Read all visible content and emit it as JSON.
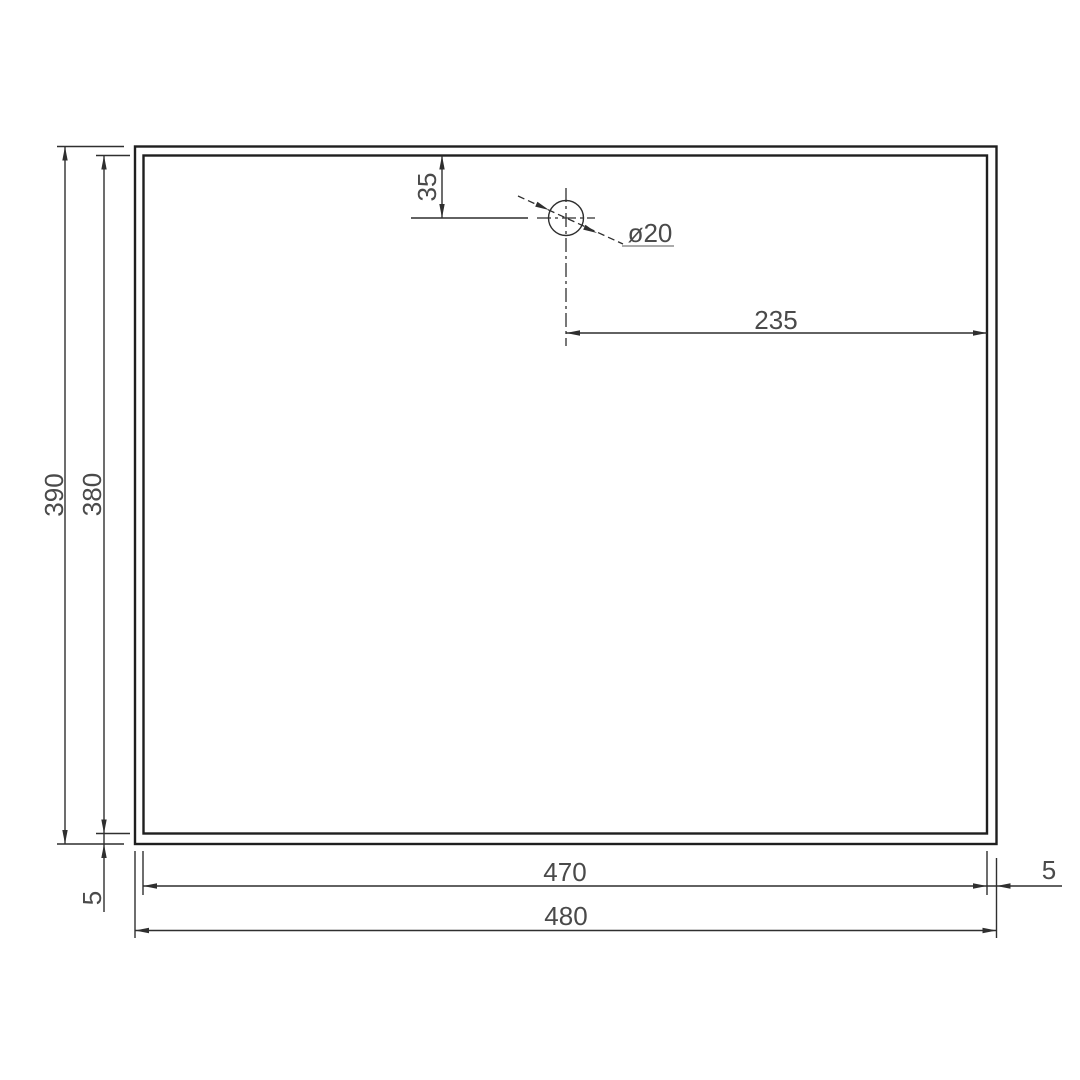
{
  "drawing": {
    "type": "engineering-dimension-drawing",
    "background_color": "#ffffff",
    "outline_color": "#1f1f1f",
    "dimension_color": "#2f2f2f",
    "text_color": "#4a4a4a",
    "labels": {
      "outer_height": "390",
      "inner_height": "380",
      "outer_width": "480",
      "inner_width": "470",
      "hole_offset_top": "35",
      "hole_offset_right": "235",
      "hole_diameter": "ø20",
      "rim_gap_left": "5",
      "rim_gap_right": "5"
    }
  }
}
